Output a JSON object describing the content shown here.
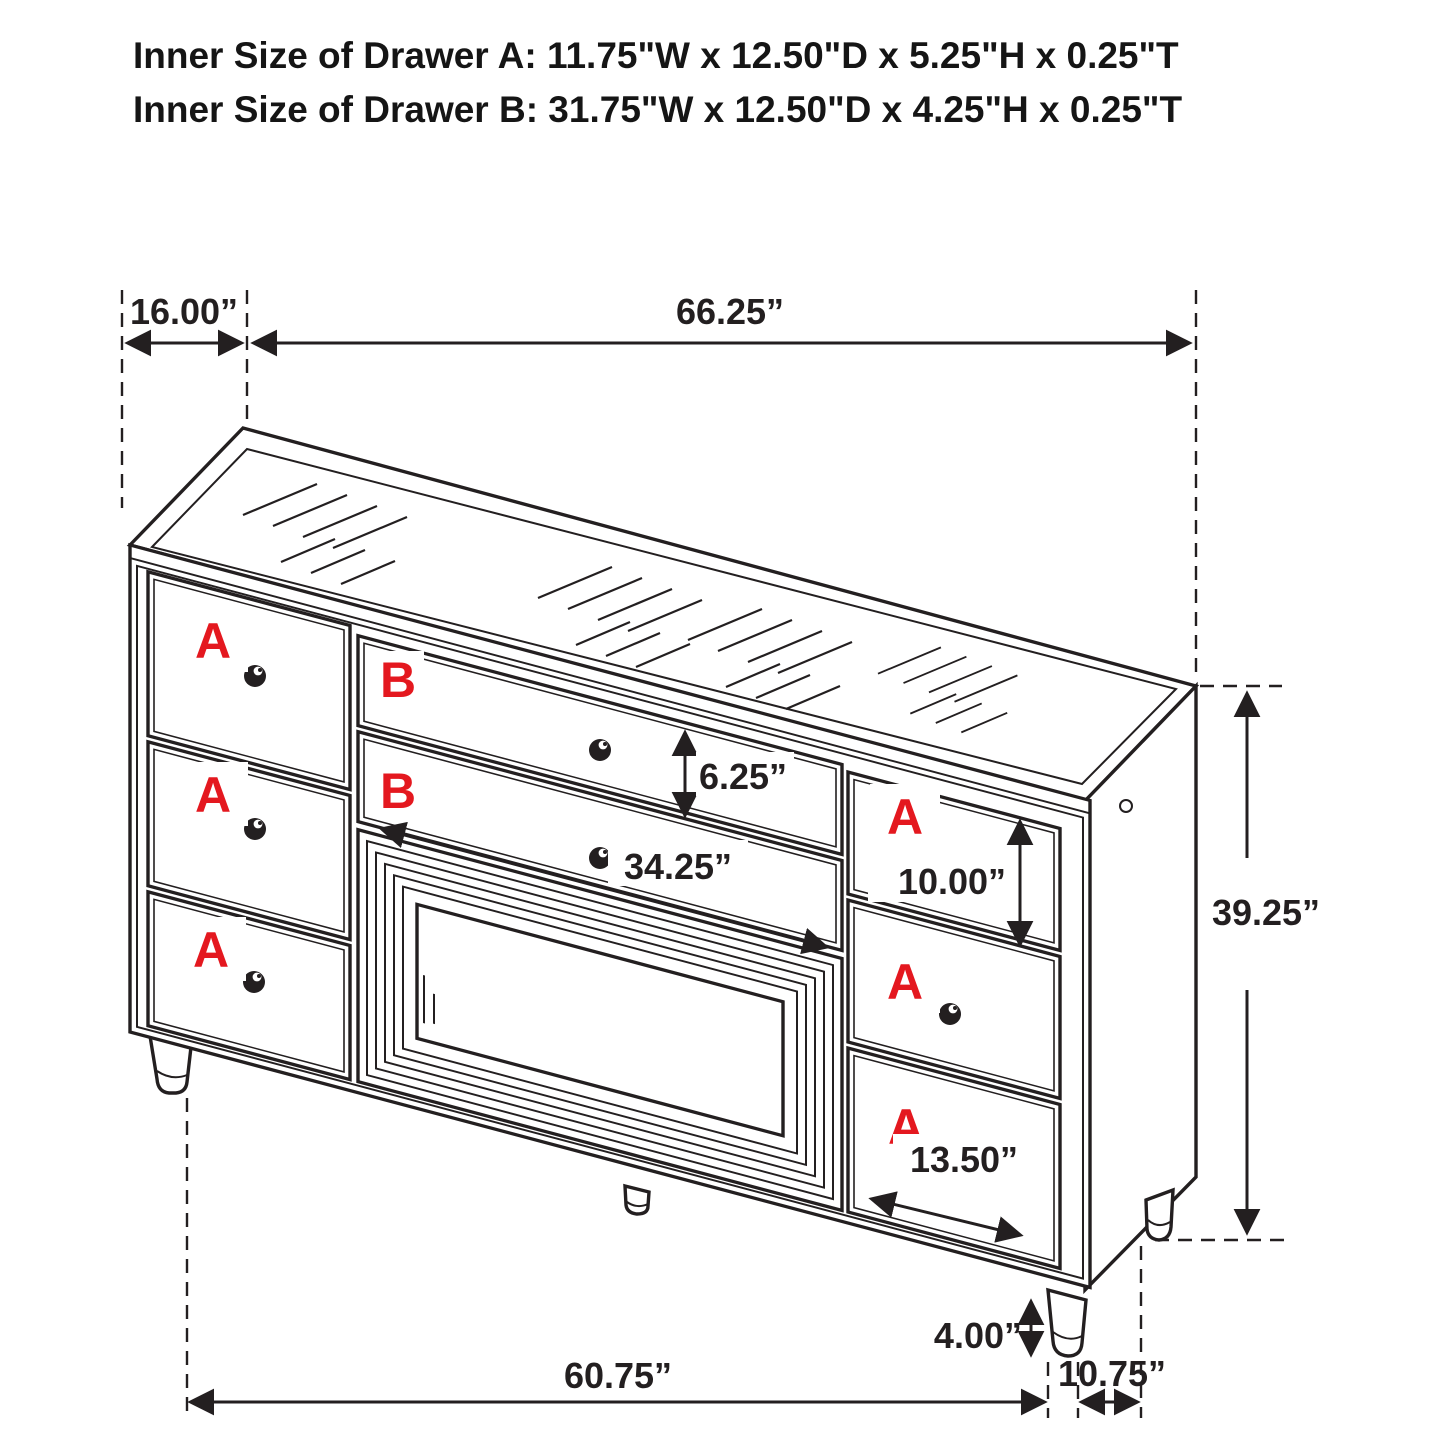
{
  "title": {
    "line1": "Inner Size of Drawer A: 11.75\"W x 12.50\"D x 5.25\"H x 0.25\"T",
    "line2": "Inner Size of Drawer B: 31.75\"W x 12.50\"D x 4.25\"H x 0.25\"T"
  },
  "drawer_labels": {
    "a": "A",
    "b": "B"
  },
  "dimensions": {
    "top_depth": "16.00”",
    "top_width": "66.25”",
    "drawer_b_height": "6.25”",
    "drawer_b_width": "34.25”",
    "right_top_drawer_height": "10.00”",
    "overall_height": "39.25”",
    "right_bottom_drawer_width": "13.50”",
    "leg_height": "4.00”",
    "bottom_width": "60.75”",
    "bottom_side_depth": "10.75”"
  },
  "colors": {
    "line": "#231f20",
    "accent_red": "#e4181f",
    "background": "#ffffff"
  }
}
